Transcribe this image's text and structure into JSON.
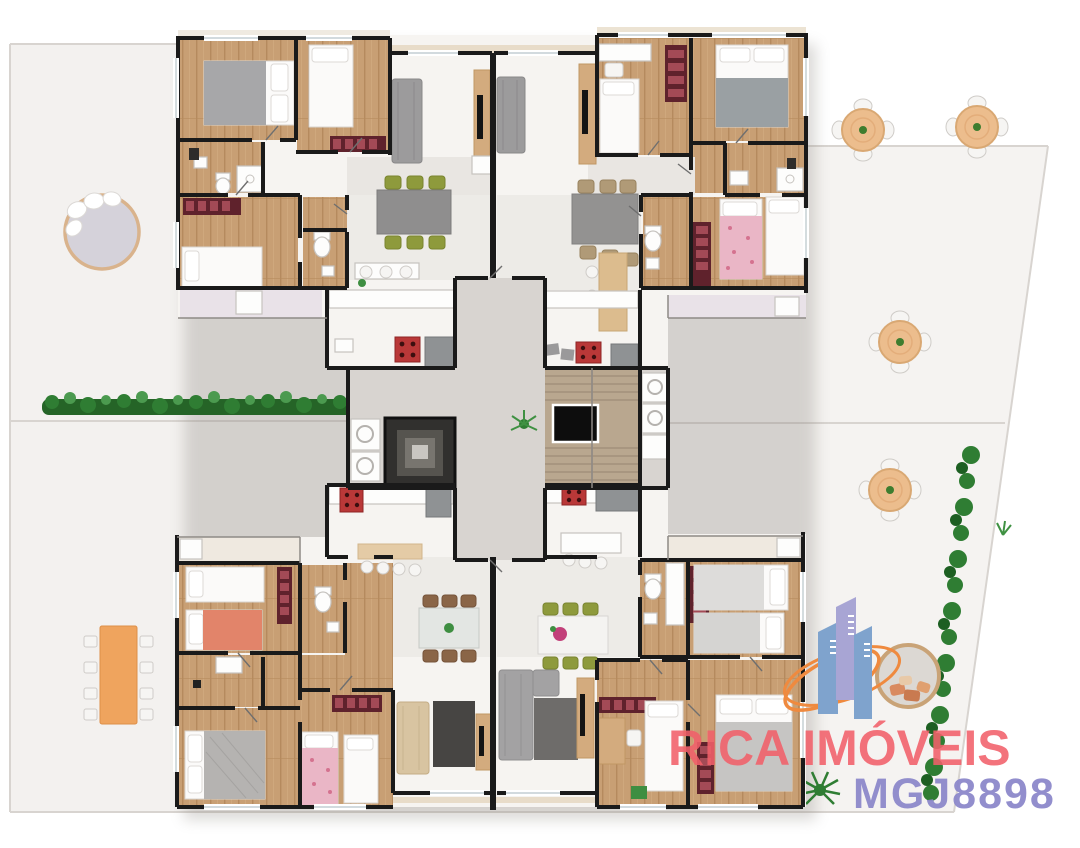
{
  "watermark": {
    "brand": "RICA IMÓVEIS",
    "code": "MGJ8898",
    "brand_color": "#f2606a",
    "code_color": "#8d89cb",
    "logo_building_blue": "#7fa3cd",
    "logo_building_purple": "#a8a5d4",
    "logo_swoosh_orange": "#ef8a3f"
  },
  "palette": {
    "ground": "#f3f1ef",
    "patio_ground": "#f5f3f1",
    "wall": "#1a1a1a",
    "wood_floor": "#c89f74",
    "living_floor": "#f7f5f2",
    "hall_floor": "#d8d4d0",
    "stairs": "#b9a78f",
    "hedge_green": "#2e7d32",
    "wardrobe_maroon": "#5f222c",
    "cooktop_red": "#b93838",
    "sofa_gray": "#9c9b9c",
    "sofa_beige": "#d8c4a1",
    "salmon_bed": "#e2846a",
    "patio_table_tan": "#ecbd8d",
    "picnic_orange": "#efa45e",
    "chair_olive": "#8e9a3c",
    "chair_brown": "#8a6547"
  },
  "scene": {
    "description": "3D top-down rendered floor plan of four apartments around a central stair core on a landscaped lot",
    "apartments": [
      "top-left",
      "top-right",
      "bottom-left",
      "bottom-right"
    ],
    "outdoor_items": [
      "round-daybed",
      "orange-picnic-table",
      "round-patio-table x4",
      "round-wicker-chair",
      "hedge-left",
      "hedge-right",
      "grass-tufts"
    ]
  }
}
